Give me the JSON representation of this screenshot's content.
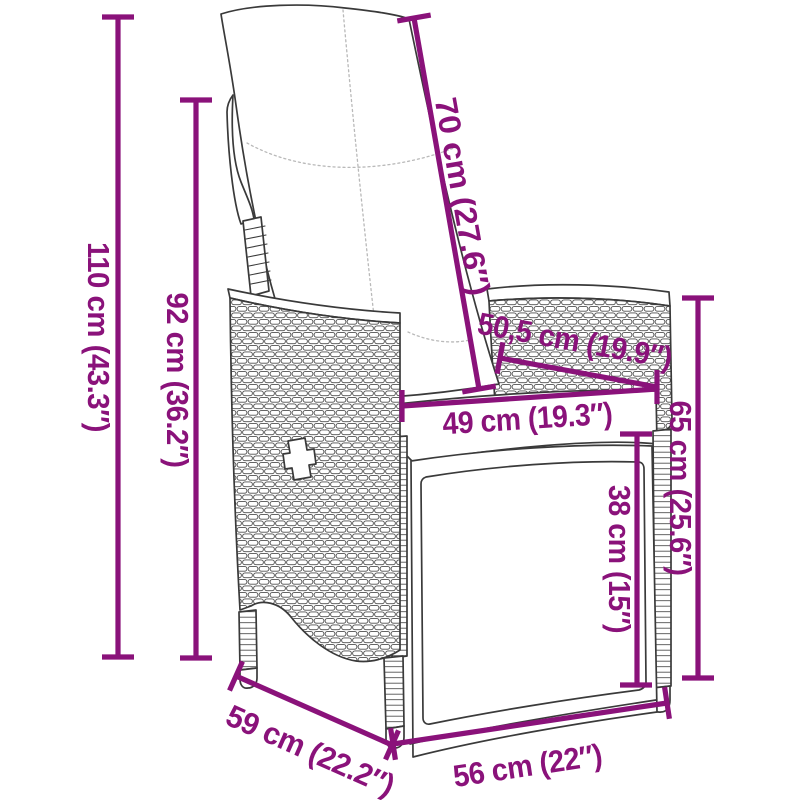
{
  "diagram": {
    "kind": "product-dimension-diagram",
    "subject": "reclining-garden-chair-with-cushions",
    "colors": {
      "dimension": "#8A127A",
      "line_art": "#3A3A3A"
    },
    "dimensions": {
      "total_height": "110 cm (43.3″)",
      "back_height": "92 cm (36.2″)",
      "backrest_length": "70 cm (27.6″)",
      "armrest_diagonal": "50,5 cm (19.9″)",
      "seat_depth_inner": "49 cm (19.3″)",
      "armrest_height": "65 cm (25.6″)",
      "seat_height": "38 cm (15″)",
      "base_depth": "59 cm (22.2″)",
      "base_width": "56 cm (22″)"
    }
  }
}
